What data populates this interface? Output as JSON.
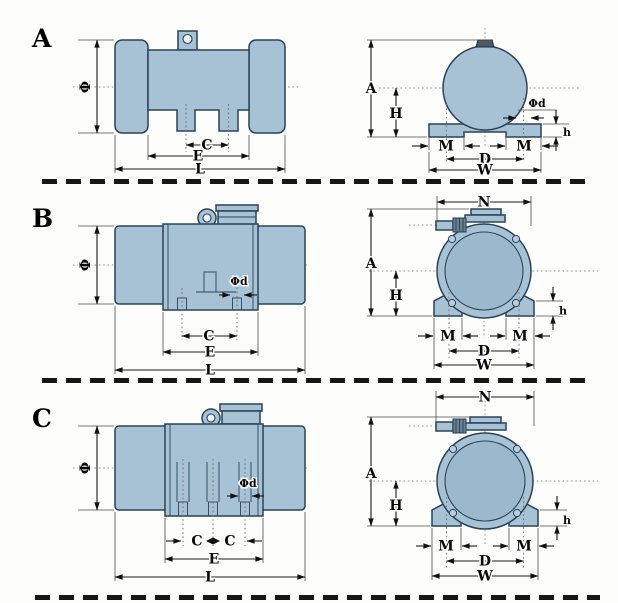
{
  "figure": {
    "description": "Vibration motor dimensional drawings, three variants with side and front views",
    "background": "#ffffff",
    "body_color": "#a7c1d5",
    "outline_color": "#2a4358"
  },
  "rows": [
    {
      "label": "A",
      "side": {
        "phi": "Φ",
        "c": "C",
        "e": "E",
        "l": "L"
      },
      "front": {
        "a": "A",
        "h_cap": "H",
        "phid": "Φd",
        "h": "h",
        "m1": "M",
        "m2": "M",
        "d": "D",
        "w": "W"
      }
    },
    {
      "label": "B",
      "side": {
        "phi": "Φ",
        "phid": "Φd",
        "c": "C",
        "e": "E",
        "l": "L"
      },
      "front": {
        "n": "N",
        "a": "A",
        "h_cap": "H",
        "h": "h",
        "m1": "M",
        "m2": "M",
        "d": "D",
        "w": "W"
      }
    },
    {
      "label": "C",
      "side": {
        "phi": "Φ",
        "phid": "Φd",
        "c1": "C",
        "c2": "C",
        "e": "E",
        "l": "L"
      },
      "front": {
        "n": "N",
        "a": "A",
        "h_cap": "H",
        "h": "h",
        "m1": "M",
        "m2": "M",
        "d": "D",
        "w": "W"
      }
    }
  ]
}
